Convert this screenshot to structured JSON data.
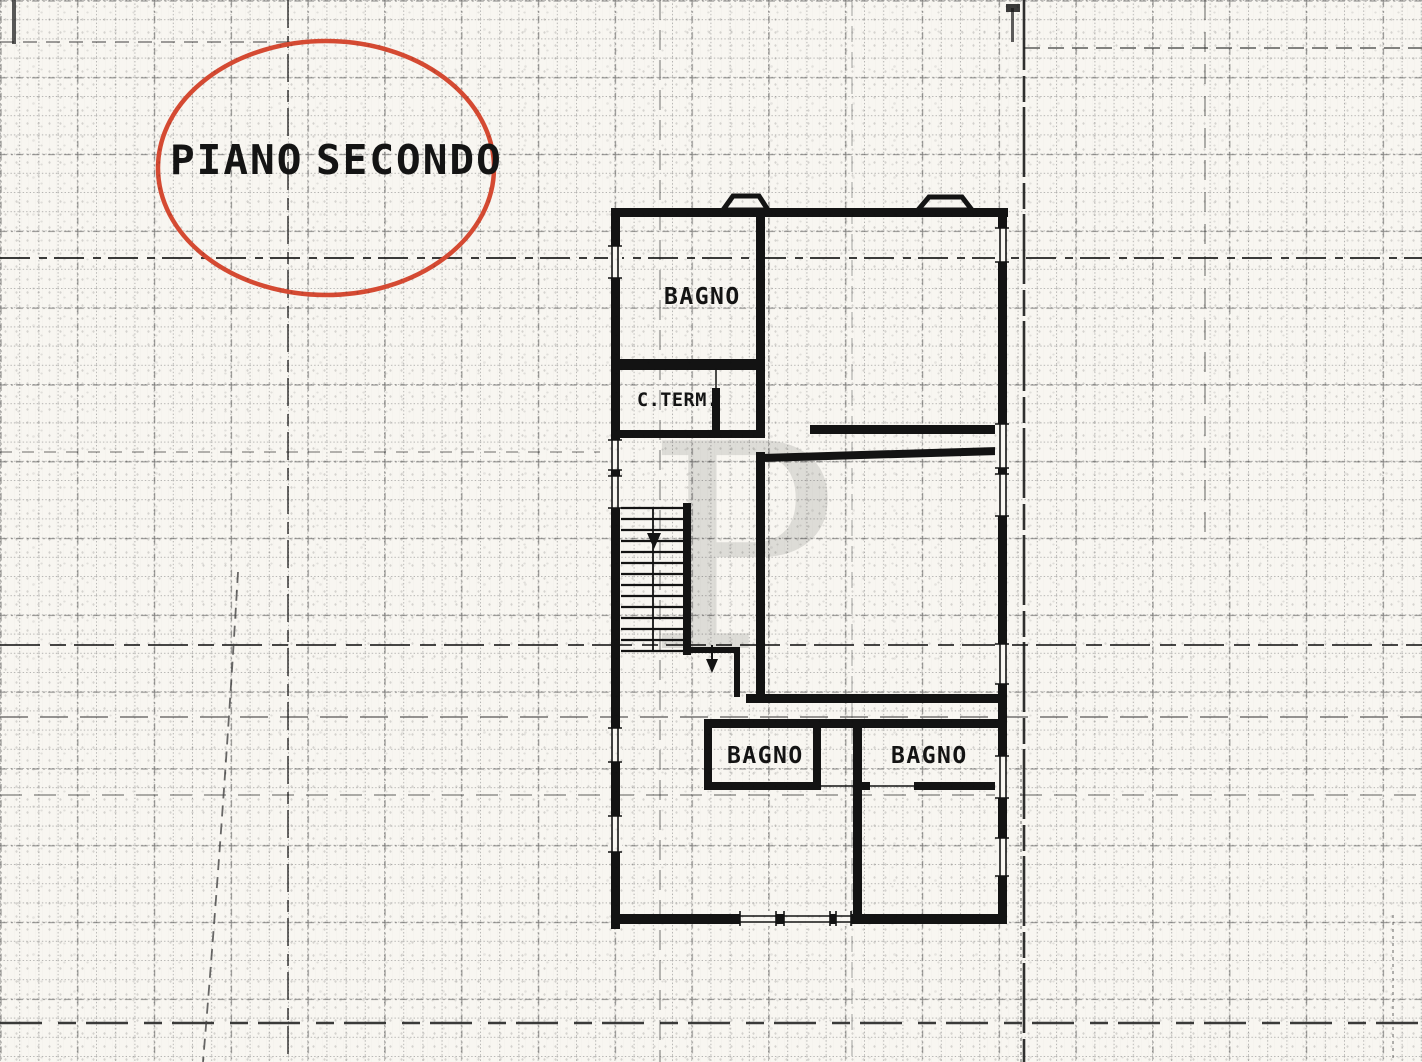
{
  "page": {
    "kind": "scanned cadastral floor plan on graph paper",
    "paper_color": "#f8f6f1",
    "ink_color": "#131313"
  },
  "title": {
    "full": "PIANO SECONDO",
    "word1": "PIANO",
    "word2": "SECONDO",
    "circle_color": "#d54a32"
  },
  "watermark": {
    "letter": "P"
  },
  "rooms": {
    "bagno_top": {
      "label": "BAGNO"
    },
    "cterm": {
      "label": "C.TERM."
    },
    "bagno_bottom_left": {
      "label": "BAGNO"
    },
    "bagno_bottom_right": {
      "label": "BAGNO"
    }
  }
}
